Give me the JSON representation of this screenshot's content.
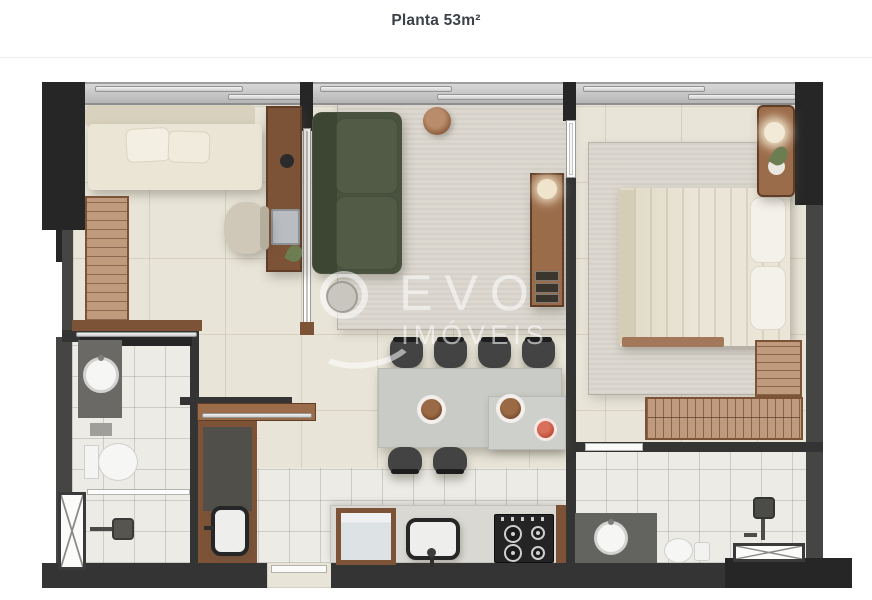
{
  "header": {
    "title": "Planta 53m²"
  },
  "watermark": {
    "brand": "EVO",
    "subtitle": "IMÓVEIS"
  },
  "palette": {
    "wall": "#343434",
    "wall_soft": "#454543",
    "floor": "#e8e4d8",
    "tile": "#edebe6",
    "rug": "#dcd8d0",
    "wood": "#7d5338",
    "wood_mid": "#9b6c4a",
    "wood_light": "#c09a7d",
    "sofa_green": "#49523e",
    "sofa_green_light": "#525b46",
    "counter": "#d9d8d3",
    "table": "#c9cbc7",
    "chair": "#434343",
    "fruit": "#b94b36",
    "plant": "#6d7d52",
    "bed": "#eae5d7",
    "wm": "rgba(255,255,255,0.55)"
  }
}
